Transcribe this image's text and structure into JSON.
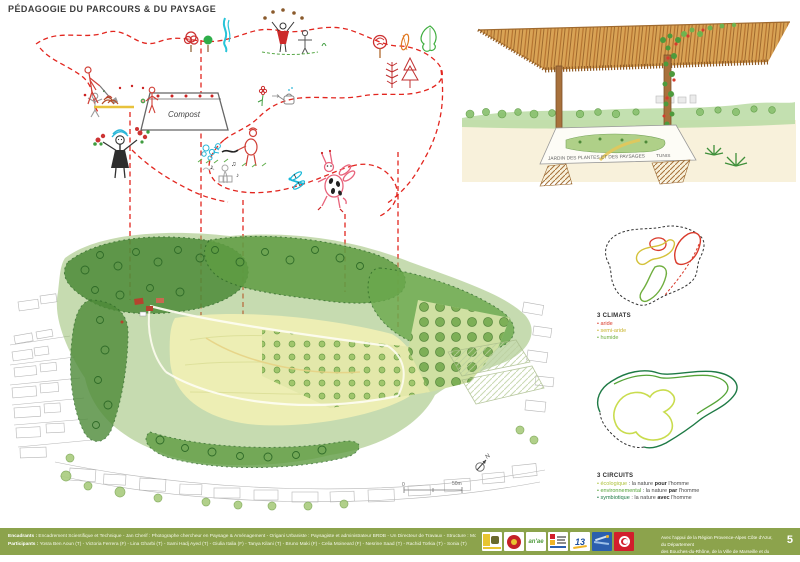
{
  "page": {
    "title": "PÉDAGOGIE DU PARCOURS & DU PAYSAGE",
    "page_number": "5"
  },
  "colors": {
    "footer_green": "#8ca34c",
    "path_dashed_red": "#e2261f",
    "climat_aride": "#d93a2b",
    "climat_semi_aride": "#c9b52f",
    "climat_humide": "#6fae3e",
    "circuit_ecologique": "#aec23c",
    "circuit_environnemental": "#55a437",
    "circuit_symbiotique": "#1e7a45"
  },
  "collage": {
    "compost_label": "Compost"
  },
  "perspective": {
    "table_label": "JARDIN DES PLANTES ET DES PAYSAGES",
    "city_label": "TUNIS"
  },
  "plan": {
    "north_label": "N",
    "scale_start": "0",
    "scale_end": "50m"
  },
  "diagram_climats": {
    "title": "3 CLIMATS",
    "items": [
      {
        "label": "• aride",
        "color": "#d93a2b"
      },
      {
        "label": "• semi-aride",
        "color": "#c9b52f"
      },
      {
        "label": "• humide",
        "color": "#6fae3e"
      }
    ]
  },
  "diagram_circuits": {
    "title": "3 CIRCUITS",
    "items": [
      {
        "keyword": "• écologique",
        "mid": " : la nature ",
        "emphasis": "pour",
        "tail": " l'homme",
        "color": "#aec23c"
      },
      {
        "keyword": "• environnemental",
        "mid": " : la nature ",
        "emphasis": "par",
        "tail": " l'homme",
        "color": "#55a437"
      },
      {
        "keyword": "• symbiotique",
        "mid": " : la nature ",
        "emphasis": "avec",
        "tail": " l'homme",
        "color": "#1e7a45"
      }
    ]
  },
  "footer": {
    "credits": {
      "line1_label": "Encadrants :",
      "line1_text": " Encadrement Scientifique et Technique - Jan Cherif : Photographe chercheur en Paysage & Aménagement - Origani Urbaniste : Paysagiste et administrateur BRDB - Un Directeur de Travaux - Structure : Mounier - Vice Président du Salle et Administrateur - Ornementale : Monsieur, Président du HSB",
      "line2_label": "Participants :",
      "line2_text": " Yosra Ben Aoun (T) - Victoria Ferrera (F) - Lina Gharbi (T) - Sami Hadj Ayed (T) - Giulia Italia (F) - Tanya Kilani (T) - Bruno Maki (F) - Celia Moineard (F) - Nesrine Saad (T) - Rachid Torkia (T) - Sonia (T)"
    },
    "support_line1": "Avec l'appui de la Région Provence-Alpes Côte d'Azur, du Département",
    "support_line2": "des Bouches-du-Rhône, de la Ville de Marseille et du Gouvernement de Tunis",
    "logos": {
      "anae_text": "an'ae",
      "cg13_text": "13"
    }
  }
}
